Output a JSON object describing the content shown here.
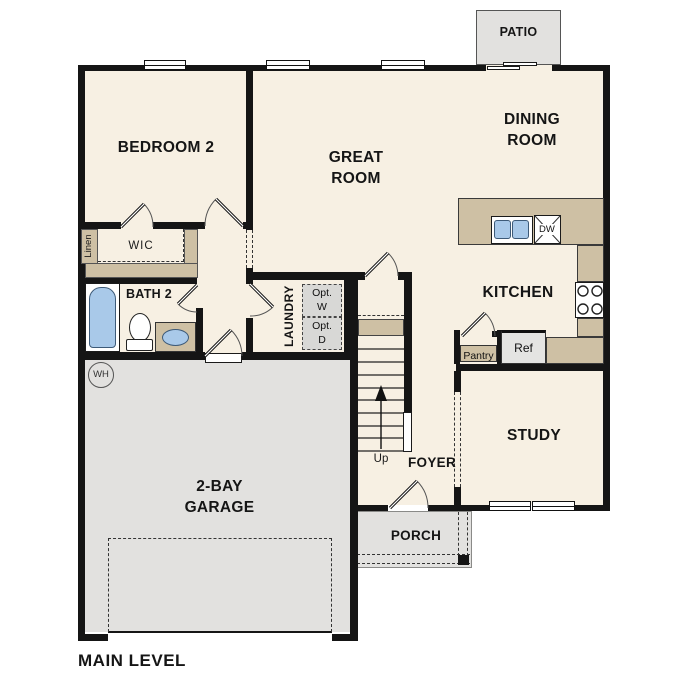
{
  "title": "MAIN LEVEL",
  "rooms": {
    "bedroom2": "BEDROOM 2",
    "great_room": "GREAT ROOM",
    "dining_room": "DINING ROOM",
    "kitchen": "KITCHEN",
    "study": "STUDY",
    "foyer": "FOYER",
    "garage": "2-BAY GARAGE",
    "bath2": "BATH 2",
    "laundry": "LAUNDRY",
    "porch": "PORCH",
    "patio": "PATIO"
  },
  "closets": {
    "wic": "WIC",
    "linen": "Linen",
    "pantry": "Pantry"
  },
  "fixtures": {
    "refrigerator": "Ref",
    "dishwasher": "DW",
    "water_heater": "WH",
    "washer_opt": "Opt. W",
    "dryer_opt": "Opt. D",
    "stairs_direction": "Up"
  },
  "colors": {
    "floor": "#f7f0e3",
    "counter": "#cec0a4",
    "exterior_concrete": "#e2e1df",
    "fixture_blue": "#a9c9e9",
    "wall": "#151515"
  }
}
